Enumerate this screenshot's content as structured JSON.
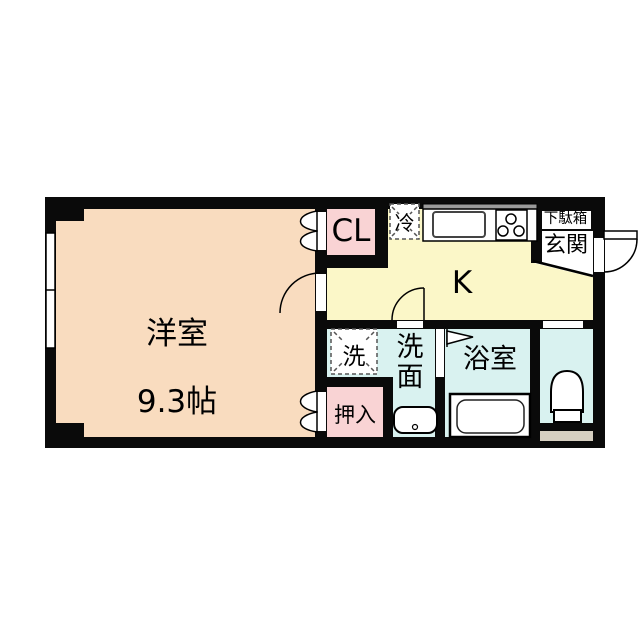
{
  "floorplan": {
    "rooms": {
      "living": {
        "name": "洋室",
        "size": "9.3帖"
      },
      "kitchen": {
        "name": "K"
      },
      "closet": {
        "name": "CL"
      },
      "refrigerator": {
        "name": "冷"
      },
      "shoe_cabinet": {
        "name": "下駄箱"
      },
      "entrance": {
        "name": "玄関"
      },
      "washer": {
        "name": "洗"
      },
      "washroom": {
        "name": "洗\n面"
      },
      "bathroom": {
        "name": "浴室"
      },
      "oshiire": {
        "name": "押入"
      }
    },
    "palette": {
      "wall": "#0a0a0a",
      "living_peach": "#f9dcbf",
      "kitchen_yellow": "#fbf7c8",
      "closet_pink": "#f9d3d4",
      "wet_area_cyan": "#d9f2f0",
      "entry_step_tan": "#d6cfc1",
      "background": "#ffffff"
    }
  }
}
